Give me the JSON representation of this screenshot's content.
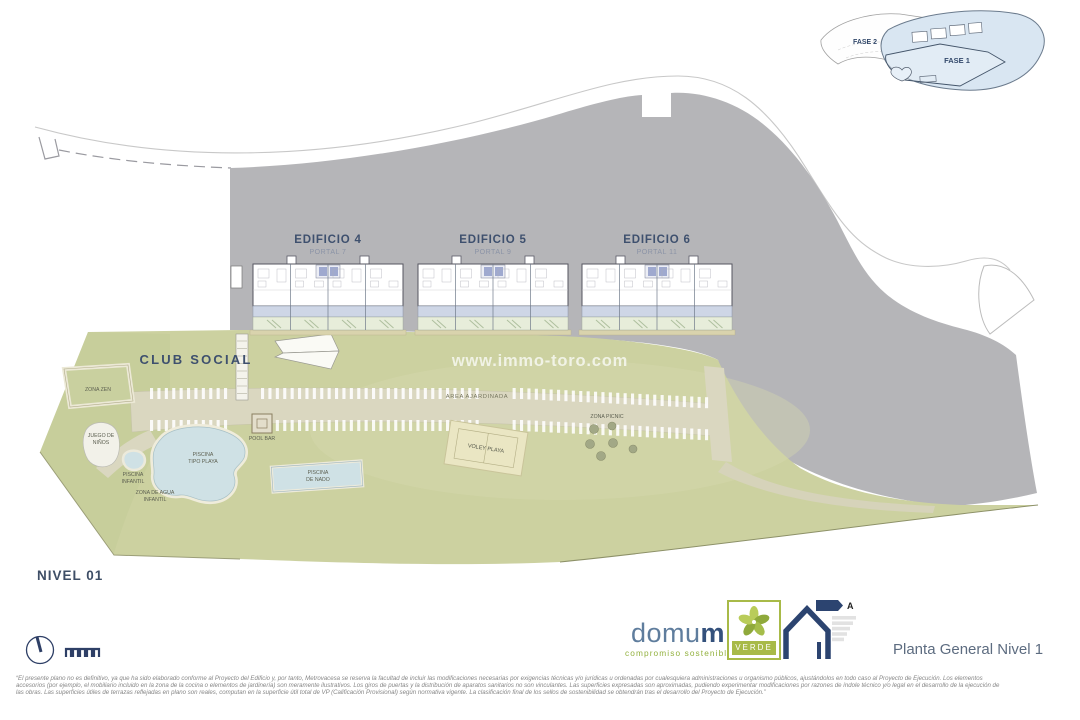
{
  "title_block": {
    "plan_title": "Planta General Nivel 1",
    "level_label": "NIVEL 01"
  },
  "inset_map": {
    "fase_1": "FASE 1",
    "fase_2": "FASE 2"
  },
  "buildings": [
    {
      "name": "EDIFICIO 4",
      "portal": "PORTAL 7"
    },
    {
      "name": "EDIFICIO 5",
      "portal": "PORTAL 9"
    },
    {
      "name": "EDIFICIO 6",
      "portal": "PORTAL 11"
    }
  ],
  "amenities": {
    "club_social": "CLUB SOCIAL",
    "zona_zen": "ZONA ZEN",
    "juego_ninos": [
      "JUEGO DE",
      "NIÑOS"
    ],
    "piscina_infantil": [
      "PISCINA",
      "INFANTIL"
    ],
    "piscina_tipo_playa": [
      "PISCINA",
      "TIPO PLAYA"
    ],
    "zona_agua_infantil": [
      "ZONA DE AGUA",
      "INFANTIL"
    ],
    "pool_bar": "POOL BAR",
    "piscina_nado": [
      "PISCINA",
      "DE NADO"
    ],
    "area_ajardinada": "AREA AJARDINADA",
    "voley_playa": "VOLEY PLAYA",
    "zona_picnic": "ZONA PICNIC"
  },
  "watermark": "www.immo-toro.com",
  "brand": {
    "name_head": "domu",
    "name_tail": "m",
    "tagline": "compromiso sostenible",
    "badge": "VERDE",
    "energy_rating": "A"
  },
  "disclaimer_lines": [
    "“El presente plano no es definitivo, ya que ha sido elaborado conforme al Proyecto del Edificio y, por tanto, Metrovacesa se reserva la facultad de incluir las modificaciones necesarias por exigencias técnicas y/o jurídicas u ordenadas por cualesquiera administraciones u organismo públicos, ajustándolos en todo caso al Proyecto de Ejecución. Los elementos",
    "accesorios (por ejemplo, el mobiliario incluido en la zona de la cocina o elementos de jardinería) son meramente ilustrativos. Los giros de puertas y la distribución de aparatos sanitarios no son vinculantes. Las superficies expresadas son aproximadas, pudiendo experimentar modificaciones por razones de índole técnico y/o legal en el desarrollo de la ejecución de",
    "las obras. Las superficies útiles de terrazas reflejadas en plano son reales, computan en la superficie útil total de VP (Calificación Provisional) según normativa vigente. La clasificación final de los sellos de sostenibilidad se obtendrán tras el desarrollo del Proyecto de Ejecución.”"
  ],
  "colors": {
    "hillside_gray": "#b5b5b8",
    "terrain_green": "#ccd1a0",
    "pool_blue": "#cfe1e5",
    "phase1_blue": "#d9e6f2",
    "brand_blue": "#34517c",
    "brand_green": "#93b13f",
    "label_blue": "#3d4f6b"
  }
}
